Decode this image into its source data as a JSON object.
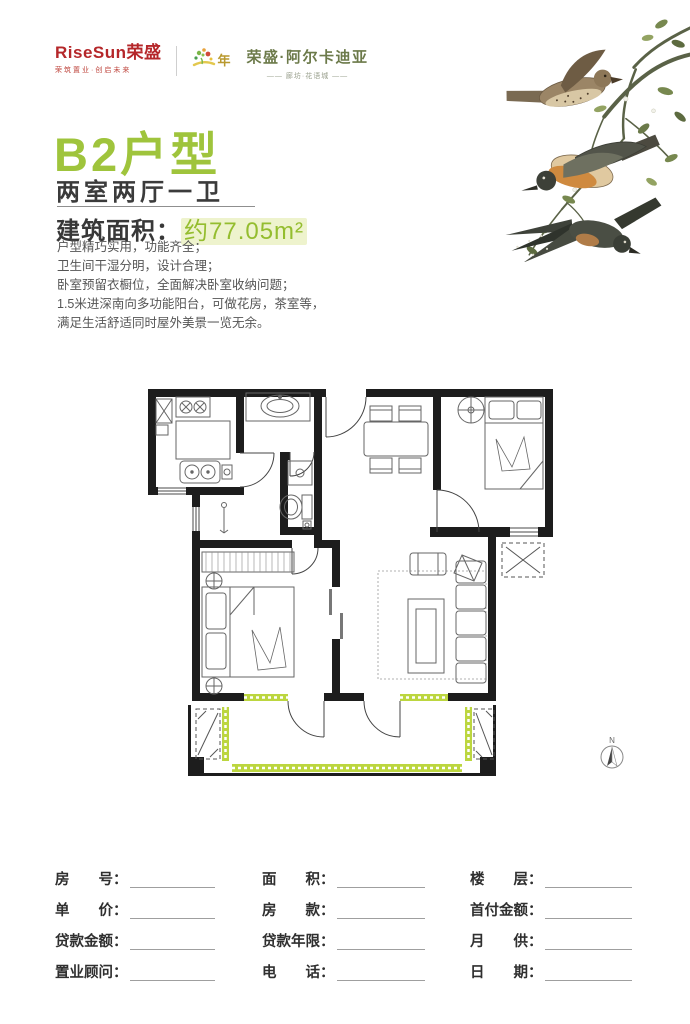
{
  "header": {
    "logo_text": "RiseSun荣盛",
    "logo_tagline": "荣筑置业·创启未来",
    "anniversary_label": "年",
    "project_name": "荣盛·阿尔卡迪亚",
    "project_subtitle": "—— 廊坊·花语城 ——"
  },
  "title_block": {
    "unit_title": "B2户型",
    "unit_layout": "两室两厅一卫",
    "area_label": "建筑面积：",
    "area_value": "约77.05m²"
  },
  "features": [
    "户型精巧实用，功能齐全；",
    "卫生间干湿分明，设计合理；",
    "卧室预留衣橱位，全面解决卧室收纳问题；",
    "1.5米进深南向多功能阳台，可做花房，茶室等，",
    "满足生活舒适同时屋外美景一览无余。"
  ],
  "floor_plan": {
    "compass_label": "N"
  },
  "form": {
    "columns": [
      {
        "fields": [
          "房　　号：",
          "单　　价：",
          "贷款金额：",
          "置业顾问："
        ]
      },
      {
        "fields": [
          "面　　积：",
          "房　　款：",
          "贷款年限：",
          "电　　话："
        ]
      },
      {
        "fields": [
          "楼　　层：",
          "首付金额：",
          "月　　供：",
          "日　　期："
        ]
      }
    ]
  },
  "icons": {
    "anniversary_mark": "floral-splash-icon",
    "bird_illustration": "watercolor-birds-on-branch",
    "compass": "north-arrow-icon"
  },
  "colors": {
    "accent_green": "#9fc43c",
    "window_green": "#bcd63f",
    "logo_red": "#b5272a",
    "wall_black": "#1d1d1d",
    "area_highlight": "#eef3cd"
  }
}
